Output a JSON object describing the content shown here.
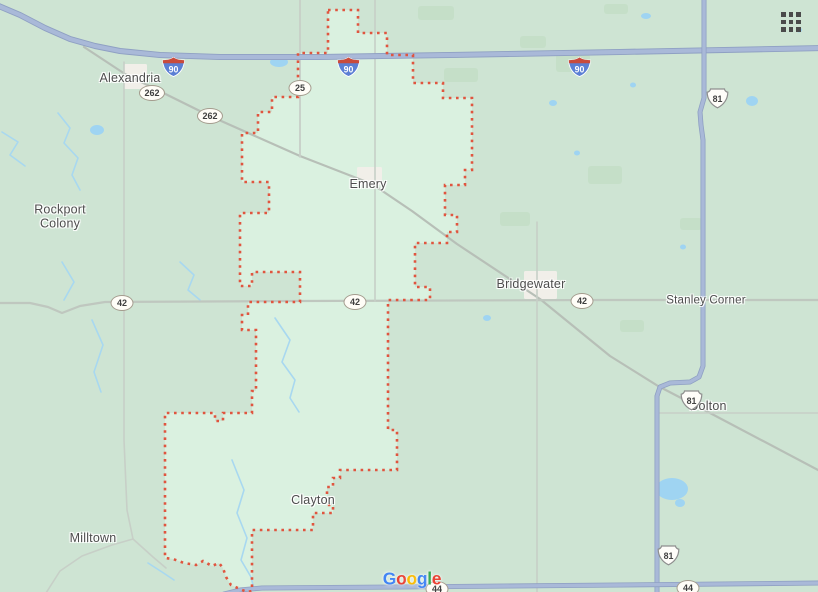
{
  "map": {
    "colors": {
      "bg": "#cee4d3",
      "patch": "#c5dfc8",
      "region_fill": "#daf1e0",
      "region_stroke": "#e0553f",
      "town": "#f1efe9",
      "pond": "#9fd4f2",
      "stream": "#a8d8f0",
      "major_casing": "#8fa0c3",
      "major_core": "#a9b9d8",
      "road_262": "#b7bfb7",
      "road_42": "#bfc7bf",
      "section_road": "#c7cfc7",
      "label_text": "#4d4d4d"
    },
    "region": {
      "id": "emery-district-boundary",
      "path": [
        [
          328,
          10
        ],
        [
          358,
          10
        ],
        [
          358,
          33
        ],
        [
          387,
          33
        ],
        [
          387,
          55
        ],
        [
          413,
          55
        ],
        [
          413,
          83
        ],
        [
          443,
          83
        ],
        [
          443,
          98
        ],
        [
          472,
          98
        ],
        [
          472,
          170
        ],
        [
          465,
          170
        ],
        [
          465,
          185
        ],
        [
          445,
          185
        ],
        [
          445,
          215
        ],
        [
          457,
          215
        ],
        [
          457,
          232
        ],
        [
          447,
          232
        ],
        [
          447,
          243
        ],
        [
          415,
          243
        ],
        [
          415,
          287
        ],
        [
          430,
          287
        ],
        [
          430,
          300
        ],
        [
          388,
          300
        ],
        [
          388,
          430
        ],
        [
          397,
          430
        ],
        [
          397,
          470
        ],
        [
          340,
          470
        ],
        [
          340,
          478
        ],
        [
          333,
          478
        ],
        [
          333,
          487
        ],
        [
          327,
          487
        ],
        [
          327,
          505
        ],
        [
          333,
          505
        ],
        [
          333,
          513
        ],
        [
          313,
          513
        ],
        [
          313,
          530
        ],
        [
          252,
          530
        ],
        [
          252,
          591
        ],
        [
          247,
          592
        ],
        [
          240,
          589
        ],
        [
          231,
          585
        ],
        [
          226,
          577
        ],
        [
          223,
          568
        ],
        [
          219,
          563
        ],
        [
          212,
          566
        ],
        [
          203,
          561
        ],
        [
          196,
          565
        ],
        [
          184,
          563
        ],
        [
          173,
          559
        ],
        [
          165,
          558
        ],
        [
          165,
          413
        ],
        [
          215,
          413
        ],
        [
          215,
          421
        ],
        [
          223,
          421
        ],
        [
          223,
          413
        ],
        [
          252,
          413
        ],
        [
          252,
          391
        ],
        [
          256,
          391
        ],
        [
          256,
          330
        ],
        [
          242,
          330
        ],
        [
          242,
          315
        ],
        [
          248,
          315
        ],
        [
          248,
          302
        ],
        [
          300,
          302
        ],
        [
          300,
          272
        ],
        [
          252,
          272
        ],
        [
          252,
          286
        ],
        [
          240,
          286
        ],
        [
          240,
          213
        ],
        [
          269,
          213
        ],
        [
          269,
          182
        ],
        [
          242,
          182
        ],
        [
          242,
          133
        ],
        [
          258,
          133
        ],
        [
          258,
          112
        ],
        [
          272,
          112
        ],
        [
          272,
          97
        ],
        [
          298,
          97
        ],
        [
          298,
          53
        ],
        [
          328,
          53
        ]
      ]
    },
    "towns": [
      {
        "id": "alexandria-town",
        "x": 124,
        "y": 64,
        "w": 23,
        "h": 25
      },
      {
        "id": "emery-town",
        "x": 357,
        "y": 167,
        "w": 25,
        "h": 18
      },
      {
        "id": "bridgewater-town",
        "x": 524,
        "y": 271,
        "w": 33,
        "h": 28
      }
    ],
    "patches": [
      [
        418,
        6,
        36,
        14
      ],
      [
        444,
        68,
        34,
        14
      ],
      [
        520,
        36,
        26,
        12
      ],
      [
        556,
        54,
        34,
        18
      ],
      [
        588,
        166,
        34,
        18
      ],
      [
        500,
        212,
        30,
        14
      ],
      [
        604,
        4,
        24,
        10
      ],
      [
        680,
        218,
        22,
        12
      ],
      [
        620,
        320,
        24,
        12
      ]
    ],
    "ponds": [
      {
        "x": 97,
        "y": 130,
        "rx": 7,
        "ry": 5
      },
      {
        "x": 279,
        "y": 62,
        "rx": 9,
        "ry": 5
      },
      {
        "x": 672,
        "y": 489,
        "rx": 16,
        "ry": 11
      },
      {
        "x": 680,
        "y": 503,
        "rx": 5,
        "ry": 4
      },
      {
        "x": 646,
        "y": 16,
        "rx": 5,
        "ry": 3
      },
      {
        "x": 752,
        "y": 101,
        "rx": 6,
        "ry": 5
      },
      {
        "x": 553,
        "y": 103,
        "rx": 4,
        "ry": 3
      },
      {
        "x": 577,
        "y": 153,
        "rx": 3,
        "ry": 2.5
      },
      {
        "x": 633,
        "y": 85,
        "rx": 3,
        "ry": 2.5
      },
      {
        "x": 487,
        "y": 318,
        "rx": 4,
        "ry": 3
      },
      {
        "x": 683,
        "y": 247,
        "rx": 3,
        "ry": 2.5
      },
      {
        "x": 799,
        "y": 30,
        "rx": 3,
        "ry": 2.5
      }
    ],
    "streams": [
      [
        [
          58,
          113
        ],
        [
          70,
          128
        ],
        [
          64,
          143
        ],
        [
          78,
          158
        ],
        [
          72,
          175
        ],
        [
          80,
          190
        ]
      ],
      [
        [
          2,
          132
        ],
        [
          18,
          142
        ],
        [
          10,
          155
        ],
        [
          25,
          166
        ]
      ],
      [
        [
          180,
          262
        ],
        [
          194,
          275
        ],
        [
          188,
          290
        ],
        [
          200,
          300
        ]
      ],
      [
        [
          62,
          262
        ],
        [
          74,
          282
        ],
        [
          64,
          300
        ]
      ],
      [
        [
          92,
          320
        ],
        [
          103,
          345
        ],
        [
          94,
          372
        ],
        [
          101,
          392
        ]
      ],
      [
        [
          275,
          318
        ],
        [
          290,
          340
        ],
        [
          282,
          362
        ],
        [
          295,
          380
        ],
        [
          290,
          398
        ],
        [
          299,
          412
        ]
      ],
      [
        [
          232,
          460
        ],
        [
          244,
          490
        ],
        [
          237,
          513
        ],
        [
          247,
          538
        ],
        [
          241,
          560
        ],
        [
          251,
          577
        ],
        [
          254,
          589
        ]
      ],
      [
        [
          148,
          563
        ],
        [
          162,
          572
        ],
        [
          174,
          580
        ]
      ]
    ],
    "minor_roads": [
      {
        "id": "road-hwy262-diagonal",
        "cls": "road_262",
        "w": 2.2,
        "pts": [
          [
            84,
            47
          ],
          [
            125,
            74
          ],
          [
            210,
            116
          ],
          [
            300,
            156
          ],
          [
            372,
            184
          ],
          [
            412,
            211
          ],
          [
            457,
            244
          ],
          [
            540,
            299
          ],
          [
            610,
            356
          ],
          [
            658,
            386
          ],
          [
            710,
            413
          ],
          [
            820,
            471
          ]
        ]
      },
      {
        "id": "road-sd42",
        "cls": "road_42",
        "w": 2.2,
        "pts": [
          [
            -2,
            303
          ],
          [
            30,
            303
          ],
          [
            48,
            307
          ],
          [
            62,
            313
          ],
          [
            80,
            306
          ],
          [
            105,
            302
          ],
          [
            300,
            301
          ],
          [
            600,
            300
          ],
          [
            820,
            300
          ]
        ]
      },
      {
        "id": "road-sd25",
        "cls": "section_road",
        "w": 1.8,
        "pts": [
          [
            300,
            -2
          ],
          [
            300,
            157
          ]
        ]
      },
      {
        "id": "road-section-emery",
        "cls": "section_road",
        "w": 1.6,
        "pts": [
          [
            375,
            -2
          ],
          [
            375,
            301
          ]
        ]
      },
      {
        "id": "road-section-alexandria",
        "cls": "section_road",
        "w": 1.6,
        "pts": [
          [
            124,
            62
          ],
          [
            124,
            440
          ],
          [
            127,
            510
          ],
          [
            133,
            539
          ]
        ]
      },
      {
        "id": "road-section-bridgewater",
        "cls": "section_road",
        "w": 1.6,
        "pts": [
          [
            537,
            222
          ],
          [
            537,
            594
          ]
        ]
      },
      {
        "id": "road-dolton-east",
        "cls": "section_road",
        "w": 1.6,
        "pts": [
          [
            657,
            413
          ],
          [
            820,
            413
          ]
        ]
      },
      {
        "id": "road-milltown-west",
        "cls": "section_road",
        "w": 1.6,
        "pts": [
          [
            46,
            593
          ],
          [
            60,
            571
          ],
          [
            82,
            556
          ],
          [
            112,
            545
          ],
          [
            133,
            539
          ]
        ]
      },
      {
        "id": "road-milltown-east",
        "cls": "section_road",
        "w": 1.6,
        "pts": [
          [
            133,
            539
          ],
          [
            153,
            557
          ],
          [
            166,
            568
          ]
        ]
      }
    ],
    "major_roads": [
      {
        "id": "road-i90",
        "casing": 6,
        "core": 4.2,
        "pts": [
          [
            -6,
            4
          ],
          [
            20,
            15
          ],
          [
            45,
            28
          ],
          [
            70,
            39
          ],
          [
            95,
            46
          ],
          [
            120,
            51
          ],
          [
            160,
            55
          ],
          [
            220,
            57
          ],
          [
            320,
            57
          ],
          [
            450,
            55
          ],
          [
            620,
            52
          ],
          [
            824,
            48
          ]
        ]
      },
      {
        "id": "road-us81",
        "casing": 5,
        "core": 3.4,
        "pts": [
          [
            704,
            -4
          ],
          [
            704,
            98
          ],
          [
            700,
            112
          ],
          [
            701,
            125
          ],
          [
            703,
            140
          ],
          [
            703,
            366
          ],
          [
            699,
            377
          ],
          [
            690,
            382
          ],
          [
            670,
            383
          ],
          [
            660,
            387
          ],
          [
            657,
            396
          ],
          [
            657,
            596
          ]
        ]
      },
      {
        "id": "road-sd44",
        "casing": 5,
        "core": 3.4,
        "pts": [
          [
            224,
            594
          ],
          [
            240,
            590
          ],
          [
            262,
            588
          ],
          [
            400,
            587
          ],
          [
            620,
            585
          ],
          [
            824,
            583
          ]
        ]
      }
    ]
  },
  "labels": [
    {
      "id": "alexandria",
      "lines": [
        "Alexandria"
      ],
      "x": 130,
      "y": 78,
      "cls": "lg"
    },
    {
      "id": "rockport-colony",
      "lines": [
        "Rockport",
        "Colony"
      ],
      "x": 60,
      "y": 217,
      "cls": "lg"
    },
    {
      "id": "emery",
      "lines": [
        "Emery"
      ],
      "x": 368,
      "y": 184,
      "cls": "lg"
    },
    {
      "id": "bridgewater",
      "lines": [
        "Bridgewater"
      ],
      "x": 531,
      "y": 284,
      "cls": "lg"
    },
    {
      "id": "stanley-corner",
      "lines": [
        "Stanley Corner"
      ],
      "x": 706,
      "y": 301,
      "cls": "sm"
    },
    {
      "id": "dolton",
      "lines": [
        "Dolton"
      ],
      "x": 708,
      "y": 406,
      "cls": "lg"
    },
    {
      "id": "clayton",
      "lines": [
        "Clayton"
      ],
      "x": 313,
      "y": 500,
      "cls": "lg"
    },
    {
      "id": "milltown",
      "lines": [
        "Milltown"
      ],
      "x": 93,
      "y": 538,
      "cls": "lg"
    }
  ],
  "shields": {
    "interstate_colors": {
      "body": "#5b7fd4",
      "band": "#c94b3c",
      "text": "#ffffff"
    },
    "interstate": [
      {
        "num": "90",
        "x": 162,
        "y": 57
      },
      {
        "num": "90",
        "x": 337,
        "y": 57
      },
      {
        "num": "90",
        "x": 568,
        "y": 57
      }
    ],
    "us": [
      {
        "num": "81",
        "x": 706,
        "y": 88
      },
      {
        "num": "81",
        "x": 680,
        "y": 390
      },
      {
        "num": "81",
        "x": 657,
        "y": 545
      }
    ],
    "oval": [
      {
        "num": "262",
        "x": 152,
        "y": 93
      },
      {
        "num": "262",
        "x": 210,
        "y": 116
      },
      {
        "num": "25",
        "x": 300,
        "y": 88
      },
      {
        "num": "42",
        "x": 122,
        "y": 303
      },
      {
        "num": "42",
        "x": 355,
        "y": 302
      },
      {
        "num": "42",
        "x": 582,
        "y": 301
      },
      {
        "num": "44",
        "x": 437,
        "y": 589
      },
      {
        "num": "44",
        "x": 688,
        "y": 588
      }
    ]
  },
  "apps_grid": {
    "x": 781,
    "y": 12
  },
  "google_logo": {
    "x": 412,
    "y": 579,
    "letters": [
      {
        "ch": "G",
        "color": "#4285F4"
      },
      {
        "ch": "o",
        "color": "#EA4335"
      },
      {
        "ch": "o",
        "color": "#FBBC05"
      },
      {
        "ch": "g",
        "color": "#4285F4"
      },
      {
        "ch": "l",
        "color": "#34A853"
      },
      {
        "ch": "e",
        "color": "#EA4335"
      }
    ]
  }
}
